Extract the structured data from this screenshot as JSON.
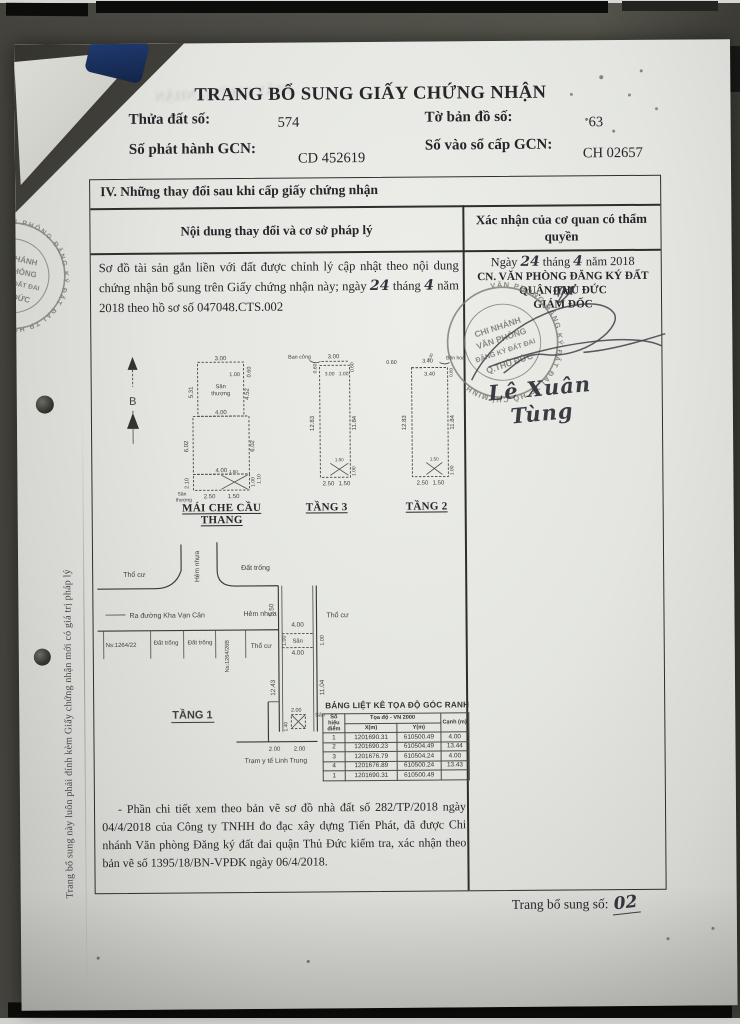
{
  "doc": {
    "title": "TRANG BỔ SUNG GIẤY CHỨNG NHẬN",
    "ghost_text": "GIẤY CHỨNG NHẬN",
    "fields": {
      "parcel_label": "Thửa đất số:",
      "parcel_value": "574",
      "map_sheet_label": "Tờ bản đồ số:",
      "map_sheet_value": "63",
      "issue_no_label": "Số phát hành GCN:",
      "issue_no_value": "CD 452619",
      "register_no_label": "Số vào sổ cấp GCN:",
      "register_no_value": "CH 02657"
    },
    "section4": {
      "heading": "IV. Những thay đổi sau khi cấp giấy chứng nhận",
      "col_content": "Nội dung thay đổi và cơ sở pháp lý",
      "col_confirm": "Xác nhận của cơ quan có thẩm quyền",
      "note": {
        "part1": "Sơ đồ tài sản gắn liền với đất được chỉnh lý cập nhật theo nội dung chứng nhận bổ sung trên Giấy chứng nhận này; ngày",
        "day": "24",
        "thang": "tháng",
        "month": "4",
        "part2": "năm 2018 theo hồ sơ số 047048.CTS.002"
      },
      "approval": {
        "date_prefix": "Ngày",
        "date_day": "24",
        "date_thang": "tháng",
        "date_month": "4",
        "date_suffix": "năm 2018",
        "office_line1": "CN. VĂN PHÒNG ĐĂNG KÝ ĐẤT ĐAI",
        "office_line2": "QUẬN THỦ ĐỨC",
        "office_line3": "GIÁM ĐỐC",
        "signer": "Lê Xuân Tùng"
      },
      "footnote": "- Phần chi tiết xem theo bản vẽ sơ đồ nhà đất số 282/TP/2018 ngày 04/4/2018 của Công ty TNHH đo đạc xây dựng Tiến Phát, đã được Chi nhánh Văn phòng Đăng ký đất đai quận Thủ Đức kiểm tra, xác nhận theo bản vẽ số 1395/18/BN-VPĐK ngày 06/4/2018."
    },
    "page_footer": {
      "label": "Trang bổ sung số:",
      "value": "02"
    },
    "side_note": "Trang bổ sung này luôn phải đính kèm Giấy chứng nhận mới có giá trị pháp lý"
  },
  "stamps": {
    "ring_text": "VĂN PHÒNG ĐĂNG KÝ ĐẤT ĐAI TP HỒ CHÍ MINH",
    "lines": {
      "l1": "CHI NHÁNH",
      "l2": "VĂN PHÒNG",
      "l3": "ĐĂNG KÝ ĐẤT ĐAI",
      "l4": "Q.THỦ ĐỨC"
    }
  },
  "diagrams": {
    "compass": {
      "label": "B"
    },
    "mai_che": {
      "name": "MÁI CHE CẦU THANG",
      "room_top_1": "Sân",
      "room_top_2": "thượng",
      "room_bottom_1": "Sân",
      "room_bottom_2": "thượng",
      "d_top": "3.00",
      "d_top_right": "0.60",
      "d_inner_top": "1.00",
      "d_left_upper": "5.31",
      "d_right_upper": "4.52",
      "d_mid": "4.00",
      "d_left_mid": "6.02",
      "d_right_mid": "6.02",
      "d_bottom_inner": "4.00",
      "d_left_lower": "2.10",
      "d_stair": "1.50",
      "d_b1": "2.50",
      "d_b2": "1.50",
      "d_r1": "1.00",
      "d_r2": "1.10"
    },
    "tang3": {
      "name": "TẦNG 3",
      "balcony": "Ban công",
      "d_top": "3.00",
      "d_left_top": "0.60",
      "d_right_top": "0.60",
      "d_inner1": "3.00",
      "d_inner2": "1.00",
      "d_left": "12.83",
      "d_right": "11.84",
      "d_stair": "1.50",
      "d_b1": "2.50",
      "d_b2": "1.50",
      "d_r": "1.00"
    },
    "tang2": {
      "name": "TẦNG 2",
      "planter": "Bồn hoa",
      "d_left_top": "0.60",
      "d_top_small": "0.60",
      "d_top": "3.40",
      "d_inner": "3.40",
      "d_right_top": "0.60",
      "d_left": "12.83",
      "d_right": "11.84",
      "d_stair": "1.50",
      "d_b1": "2.50",
      "d_b2": "1.50",
      "d_r": "1.00"
    },
    "tang1": {
      "name": "TẦNG 1",
      "labels": {
        "tho_cu_tl": "Thổ cư",
        "hem_nhua_v": "Hẻm nhựa",
        "dat_trong_top": "Đất trống",
        "ra_duong": "Ra đường Kha Vạn Cân",
        "hem_nhua_h": "Hẻm nhựa",
        "tho_cu_r": "Thổ cư",
        "ns_left": "Ns:1264/22",
        "dat_trong1": "Đất trống",
        "dat_trong2": "Đất trống",
        "ns_mid": "Ns:1264/26B",
        "tho_cu_c": "Thổ cư",
        "san_top": "Sân",
        "san_bottom": "Sân",
        "tram_y_te": "Trạm y tế Linh Trung"
      },
      "dims": {
        "d550": "5.50",
        "d400a": "4.00",
        "d100a": "1.00",
        "d400b": "4.00",
        "d100b": "1.00",
        "d1243": "12.43",
        "d1104": "11.04",
        "d200a": "2.00",
        "d140": "1.40",
        "d200b": "2.00",
        "d200c": "2.00"
      }
    }
  },
  "coord_table": {
    "title": "BẢNG LIỆT KÊ TỌA ĐỘ GÓC RANH",
    "col_point": "Số hiệu điểm",
    "col_coords": "Tọa độ - VN 2000",
    "col_x": "X(m)",
    "col_y": "Y(m)",
    "col_edge": "Cạnh (m)",
    "rows": [
      [
        "1",
        "1201690.31",
        "610500.49",
        "4.00"
      ],
      [
        "2",
        "1201690.23",
        "610504.49",
        "13.44"
      ],
      [
        "3",
        "1201676.79",
        "610504.24",
        "4.00"
      ],
      [
        "4",
        "1201676.89",
        "610500.24",
        "13.43"
      ],
      [
        "1",
        "1201690.31",
        "610500.49",
        ""
      ]
    ]
  }
}
